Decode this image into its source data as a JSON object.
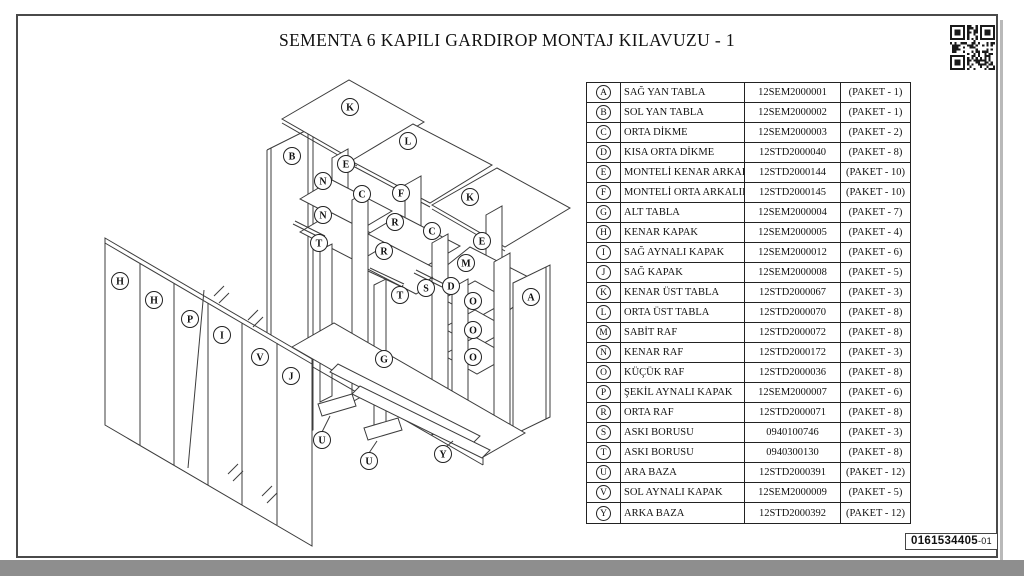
{
  "page": {
    "title": "SEMENTA 6 KAPILI GARDIROP MONTAJ KILAVUZU - 1",
    "doc_code": "0161534405",
    "doc_code_suffix": "-01"
  },
  "colors": {
    "line": "#3c3c3c",
    "sheet_border": "#4a4a4a",
    "page_edge": "#8e8e8e"
  },
  "parts_table": {
    "columns": [
      "letter",
      "name",
      "code",
      "package"
    ],
    "rows": [
      {
        "letter": "A",
        "name": "SAĞ YAN TABLA",
        "code": "12SEM2000001",
        "package": "(PAKET - 1)"
      },
      {
        "letter": "B",
        "name": "SOL YAN TABLA",
        "code": "12SEM2000002",
        "package": "(PAKET - 1)"
      },
      {
        "letter": "C",
        "name": "ORTA DİKME",
        "code": "12SEM2000003",
        "package": "(PAKET - 2)"
      },
      {
        "letter": "D",
        "name": "KISA ORTA DİKME",
        "code": "12STD2000040",
        "package": "(PAKET - 8)"
      },
      {
        "letter": "E",
        "name": "MONTELİ KENAR ARKALIK",
        "code": "12STD2000144",
        "package": "(PAKET - 10)"
      },
      {
        "letter": "F",
        "name": "MONTELİ ORTA ARKALIK",
        "code": "12STD2000145",
        "package": "(PAKET - 10)"
      },
      {
        "letter": "G",
        "name": "ALT TABLA",
        "code": "12SEM2000004",
        "package": "(PAKET - 7)"
      },
      {
        "letter": "H",
        "name": "KENAR KAPAK",
        "code": "12SEM2000005",
        "package": "(PAKET - 4)"
      },
      {
        "letter": "I",
        "name": "SAĞ AYNALI KAPAK",
        "code": "12SEM2000012",
        "package": "(PAKET - 6)"
      },
      {
        "letter": "J",
        "name": "SAĞ KAPAK",
        "code": "12SEM2000008",
        "package": "(PAKET - 5)"
      },
      {
        "letter": "K",
        "name": "KENAR ÜST TABLA",
        "code": "12STD2000067",
        "package": "(PAKET - 3)"
      },
      {
        "letter": "L",
        "name": "ORTA ÜST TABLA",
        "code": "12STD2000070",
        "package": "(PAKET - 8)"
      },
      {
        "letter": "M",
        "name": "SABİT RAF",
        "code": "12STD2000072",
        "package": "(PAKET - 8)"
      },
      {
        "letter": "N",
        "name": "KENAR RAF",
        "code": "12STD2000172",
        "package": "(PAKET - 3)"
      },
      {
        "letter": "O",
        "name": "KÜÇÜK RAF",
        "code": "12STD2000036",
        "package": "(PAKET - 8)"
      },
      {
        "letter": "P",
        "name": "ŞEKİL AYNALI KAPAK",
        "code": "12SEM2000007",
        "package": "(PAKET - 6)"
      },
      {
        "letter": "R",
        "name": "ORTA RAF",
        "code": "12STD2000071",
        "package": "(PAKET - 8)"
      },
      {
        "letter": "S",
        "name": "ASKI BORUSU",
        "code": "0940100746",
        "package": "(PAKET - 3)"
      },
      {
        "letter": "T",
        "name": "ASKI BORUSU",
        "code": "0940300130",
        "package": "(PAKET - 8)"
      },
      {
        "letter": "U",
        "name": "ARA BAZA",
        "code": "12STD2000391",
        "package": "(PAKET - 12)"
      },
      {
        "letter": "V",
        "name": "SOL AYNALI KAPAK",
        "code": "12SEM2000009",
        "package": "(PAKET - 5)"
      },
      {
        "letter": "Y",
        "name": "ARKA BAZA",
        "code": "12STD2000392",
        "package": "(PAKET - 12)"
      }
    ]
  },
  "diagram": {
    "labels": [
      {
        "letter": "K",
        "x": 350,
        "y": 107
      },
      {
        "letter": "L",
        "x": 408,
        "y": 141
      },
      {
        "letter": "K",
        "x": 470,
        "y": 197
      },
      {
        "letter": "B",
        "x": 292,
        "y": 156
      },
      {
        "letter": "E",
        "x": 346,
        "y": 164
      },
      {
        "letter": "N",
        "x": 323,
        "y": 181
      },
      {
        "letter": "N",
        "x": 323,
        "y": 215
      },
      {
        "letter": "C",
        "x": 362,
        "y": 194
      },
      {
        "letter": "F",
        "x": 401,
        "y": 193
      },
      {
        "letter": "R",
        "x": 395,
        "y": 222
      },
      {
        "letter": "R",
        "x": 384,
        "y": 251
      },
      {
        "letter": "T",
        "x": 319,
        "y": 243
      },
      {
        "letter": "T",
        "x": 400,
        "y": 295
      },
      {
        "letter": "C",
        "x": 432,
        "y": 231
      },
      {
        "letter": "E",
        "x": 482,
        "y": 241
      },
      {
        "letter": "M",
        "x": 466,
        "y": 263
      },
      {
        "letter": "S",
        "x": 426,
        "y": 288
      },
      {
        "letter": "D",
        "x": 451,
        "y": 286
      },
      {
        "letter": "O",
        "x": 473,
        "y": 301
      },
      {
        "letter": "O",
        "x": 473,
        "y": 330
      },
      {
        "letter": "O",
        "x": 473,
        "y": 357
      },
      {
        "letter": "A",
        "x": 531,
        "y": 297
      },
      {
        "letter": "G",
        "x": 384,
        "y": 359
      },
      {
        "letter": "H",
        "x": 120,
        "y": 281
      },
      {
        "letter": "H",
        "x": 154,
        "y": 300
      },
      {
        "letter": "P",
        "x": 190,
        "y": 319
      },
      {
        "letter": "I",
        "x": 222,
        "y": 335
      },
      {
        "letter": "V",
        "x": 260,
        "y": 357
      },
      {
        "letter": "J",
        "x": 291,
        "y": 376
      },
      {
        "letter": "U",
        "x": 322,
        "y": 440
      },
      {
        "letter": "U",
        "x": 369,
        "y": 461
      },
      {
        "letter": "Y",
        "x": 443,
        "y": 454
      }
    ]
  }
}
